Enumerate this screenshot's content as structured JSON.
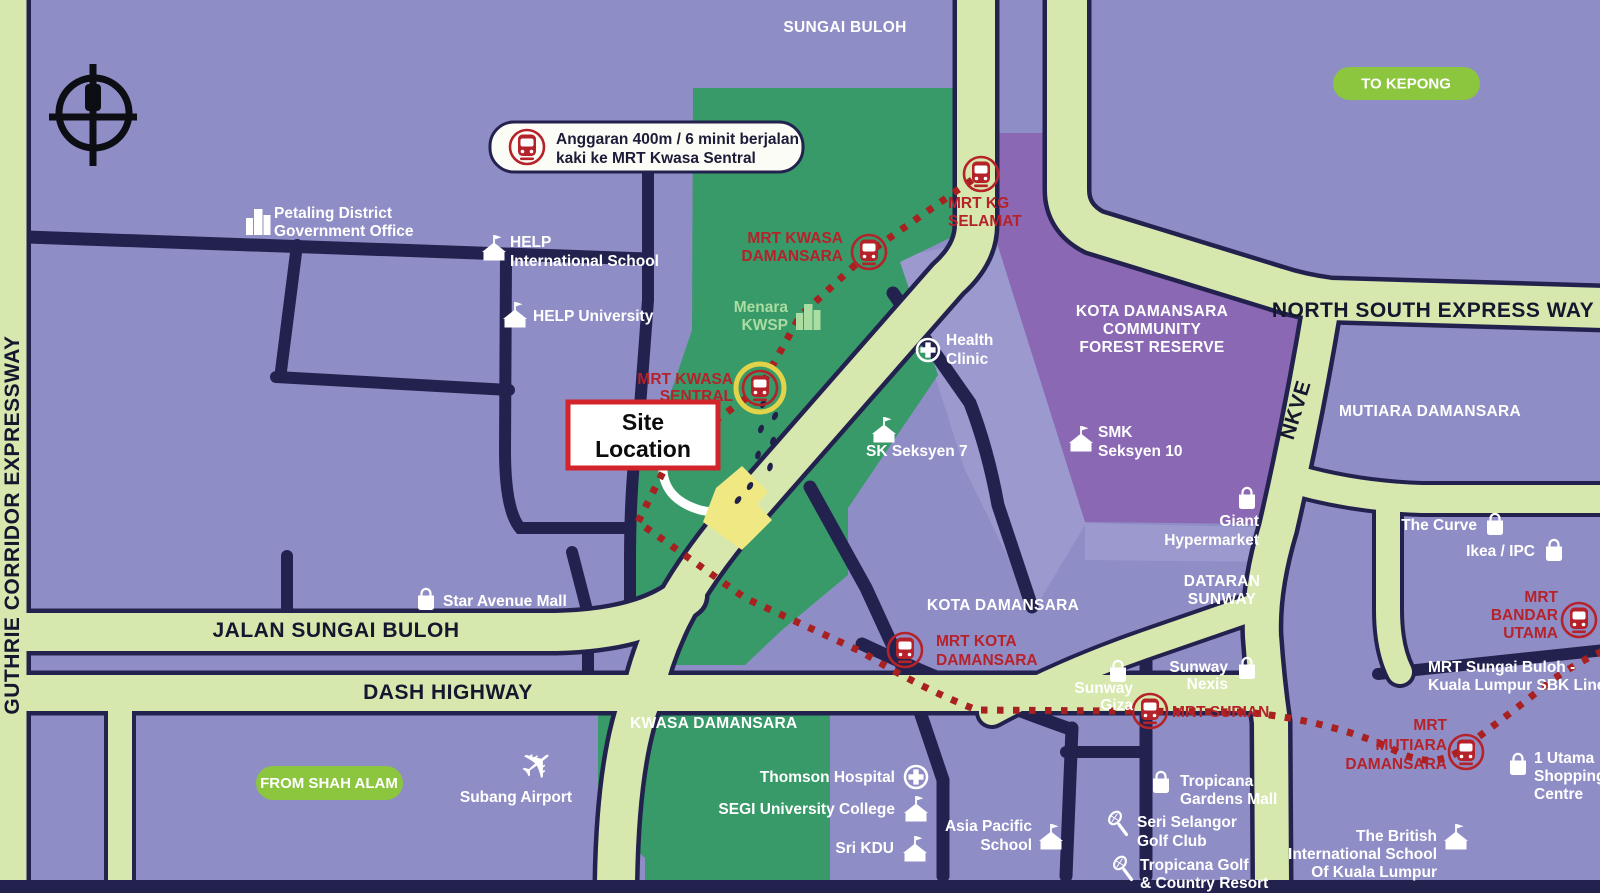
{
  "callout": {
    "line1": "Anggaran 400m / 6 minit berjalan",
    "line2": "kaki ke MRT Kwasa Sentral"
  },
  "site_box": {
    "line1": "Site",
    "line2": "Location"
  },
  "pills": {
    "to_kepong": "TO KEPONG",
    "from_shah_alam": "FROM SHAH ALAM"
  },
  "roads": {
    "guthrie": "GUTHRIE CORRIDOR EXPRESSWAY",
    "north_south": "NORTH SOUTH EXPRESS WAY",
    "nkve": "NKVE",
    "jalan_sungai_buloh": "JALAN SUNGAI BULOH",
    "dash_highway": "DASH HIGHWAY",
    "sbk_line": [
      "MRT Sungai Buloh -",
      "Kuala Lumpur SBK Line"
    ]
  },
  "areas": {
    "sungai_buloh": "SUNGAI BULOH",
    "forest_reserve": [
      "KOTA DAMANSARA",
      "COMMUNITY",
      "FOREST RESERVE"
    ],
    "mutiara_damansara": "MUTIARA DAMANSARA",
    "dataran_sunway": [
      "DATARAN",
      "SUNWAY"
    ],
    "kota_damansara": "KOTA DAMANSARA",
    "kwasa_damansara": "KWASA DAMANSARA"
  },
  "stations": {
    "kg_selamat": [
      "MRT KG",
      "SELAMAT"
    ],
    "kwasa_damansara": [
      "MRT KWASA",
      "DAMANSARA"
    ],
    "kwasa_sentral": [
      "MRT KWASA",
      "SENTRAL"
    ],
    "kota_damansara": [
      "MRT KOTA",
      "DAMANSARA"
    ],
    "surian": [
      "MRT SURIAN"
    ],
    "mutiara_damansara": [
      "MRT",
      "MUTIARA",
      "DAMANSARA"
    ],
    "bandar_utama": [
      "MRT",
      "BANDAR",
      "UTAMA"
    ]
  },
  "landmarks": {
    "petaling": [
      "Petaling District",
      "Government Office"
    ],
    "help_intl": [
      "HELP",
      "International School"
    ],
    "help_univ": [
      "HELP University"
    ],
    "menara_kwsp": [
      "Menara",
      "KWSP"
    ],
    "health_clinic": [
      "Health",
      "Clinic"
    ],
    "sk_seksyen7": [
      "SK Seksyen 7"
    ],
    "smk_seksyen10": [
      "SMK",
      "Seksyen 10"
    ],
    "giant": [
      "Giant",
      "Hypermarket"
    ],
    "the_curve": [
      "The Curve"
    ],
    "ikea_ipc": [
      "Ikea / IPC"
    ],
    "star_avenue": [
      "Star Avenue Mall"
    ],
    "subang_airport": [
      "Subang Airport"
    ],
    "thomson": [
      "Thomson Hospital"
    ],
    "segi": [
      "SEGI University College"
    ],
    "sri_kdu": [
      "Sri KDU"
    ],
    "asia_pacific": [
      "Asia Pacific",
      "School"
    ],
    "sunway_giza": [
      "Sunway",
      "Giza"
    ],
    "sunway_nexis": [
      "Sunway",
      "Nexis"
    ],
    "tropicana_gardens": [
      "Tropicana",
      "Gardens Mall"
    ],
    "seri_selangor": [
      "Seri Selangor",
      "Golf Club"
    ],
    "tropicana_golf": [
      "Tropicana Golf",
      "& Country Resort"
    ],
    "one_utama": [
      "1 Utama",
      "Shopping",
      "Centre"
    ],
    "british_school": [
      "The British",
      "International School",
      "Of Kuala Lumpur"
    ]
  },
  "icons": {
    "plane": "✈"
  },
  "colors": {
    "base": "#8F8DC5",
    "base_light": "#9B99CE",
    "development_green": "#389969",
    "forest_purple": "#8A68B4",
    "road_fill": "#D6E8AE",
    "road_border": "#23224F",
    "mrt_red": "#B5222A",
    "site_yellow": "#EFE883",
    "pill_green": "#8CC63E",
    "highlight_ring": "#E3D34B"
  }
}
